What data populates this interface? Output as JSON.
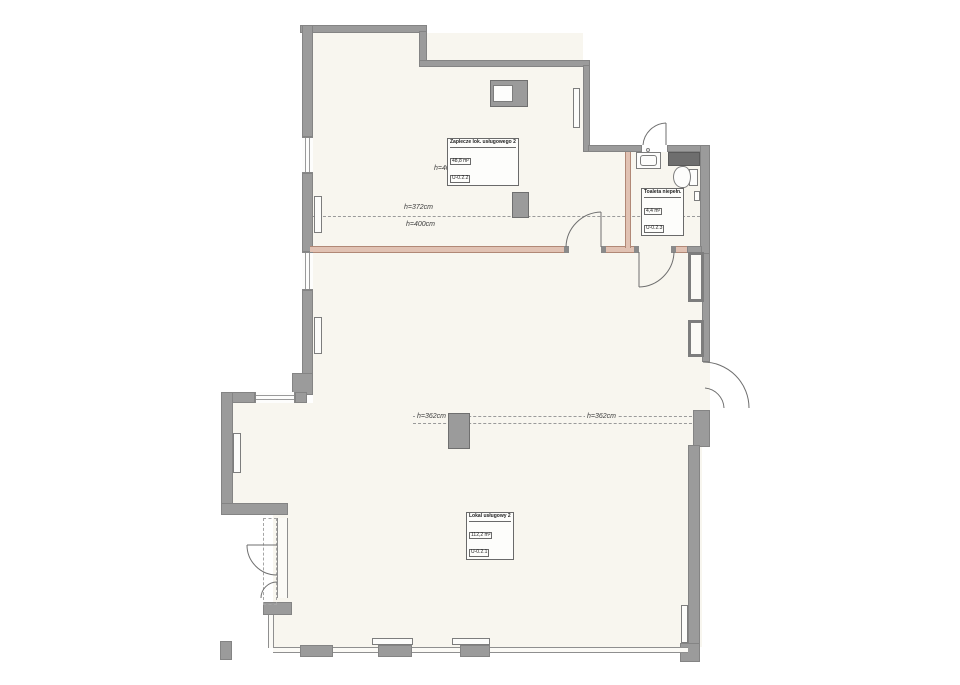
{
  "document": {
    "type": "floor-plan",
    "colors": {
      "wall": "#9b9b9b",
      "wall_dark": "#6e6e6e",
      "new_wall_fill": "#e1c2b3",
      "new_wall_edge": "#b18876",
      "floor": "#f8f6ef",
      "background": "#ffffff"
    }
  },
  "rooms": [
    {
      "name": "Zaplecze lok. usługowego 2",
      "area": "48,8 m²",
      "code": "U-0.2.2"
    },
    {
      "name": "Toaleta niepełn.",
      "area": "4,4 m²",
      "code": "U-0.2.3"
    },
    {
      "name": "Lokal usługowy 2",
      "area": "112,2 m²",
      "code": "U-0.2.1"
    }
  ],
  "heights": {
    "top_room": "h=400cm",
    "mid_left_upper": "h=372cm",
    "mid_left_lower": "h=400cm",
    "mid_right_upper": "h=372cm",
    "mid_right_lower": "h=400cm",
    "lower_left": "h=362cm",
    "lower_right": "h=362cm",
    "lower_room": "h=400cm"
  }
}
